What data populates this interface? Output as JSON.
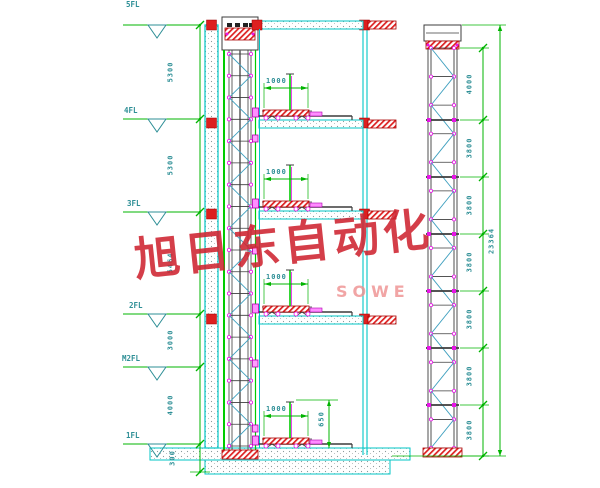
{
  "floors": {
    "labels": [
      "5FL",
      "4FL",
      "3FL",
      "2FL",
      "M2FL",
      "1FL"
    ]
  },
  "dims": {
    "left": [
      "5300",
      "5300",
      "5464",
      "3000",
      "4000",
      "300"
    ],
    "right": [
      "4000",
      "3800",
      "3800",
      "3800",
      "3800",
      "3800",
      "3800"
    ],
    "overall": "23364",
    "platform_width": "1000",
    "pit_height": "650"
  },
  "watermark": {
    "text": "旭日东自动化",
    "brand": "SOWE"
  },
  "colors": {
    "wall_cyan": "#00c6c6",
    "dim_green": "#00b400",
    "label_teal": "#2e8f96",
    "magenta": "#e815e8",
    "hatch_red": "#dd1f1f",
    "line_dark": "#3c3c3c",
    "brace_teal": "#3fa0bf",
    "rail_green": "#00cc00",
    "watermark_red": "#cf2430"
  }
}
